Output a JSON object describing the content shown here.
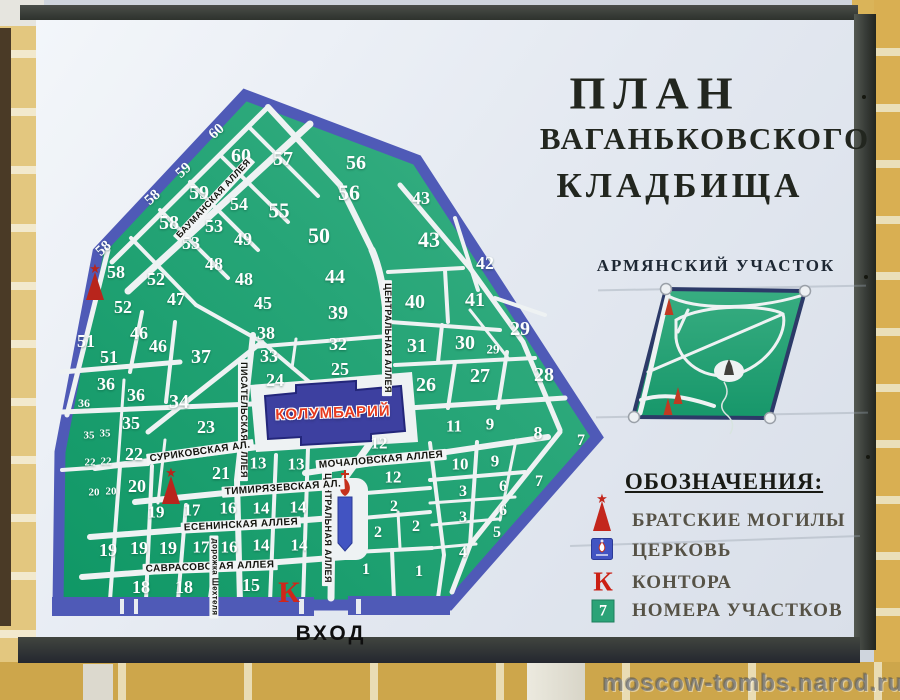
{
  "title": {
    "line1": "ПЛАН",
    "line2": "ВАГАНЬКОВСКОГО",
    "line3": "КЛАДБИЩА"
  },
  "armenian_section": {
    "label": "АРМЯНСКИЙ УЧАСТОК"
  },
  "legend": {
    "title": "ОБОЗНАЧЕНИЯ:",
    "items": [
      {
        "icon": "mass-graves-icon",
        "label": "БРАТСКИЕ МОГИЛЫ"
      },
      {
        "icon": "church-icon",
        "label": "ЦЕРКОВЬ"
      },
      {
        "icon": "office-icon",
        "label": "КОНТОРА",
        "symbol": "К"
      },
      {
        "icon": "plot-number-icon",
        "label": "НОМЕРА УЧАСТКОВ",
        "symbol": "7"
      }
    ]
  },
  "map": {
    "entrance_label": "ВХОД",
    "columbarium_label": "КОЛУМБАРИЙ",
    "office_symbol": "К",
    "plots": [
      {
        "t": "60",
        "x": 217,
        "y": 132,
        "s": 15,
        "r": -42
      },
      {
        "t": "60",
        "x": 241,
        "y": 156,
        "s": 20
      },
      {
        "t": "57",
        "x": 283,
        "y": 159,
        "s": 20
      },
      {
        "t": "56",
        "x": 356,
        "y": 163,
        "s": 20
      },
      {
        "t": "59",
        "x": 184,
        "y": 171,
        "s": 15,
        "r": -42
      },
      {
        "t": "59",
        "x": 199,
        "y": 193,
        "s": 20
      },
      {
        "t": "58",
        "x": 153,
        "y": 198,
        "s": 15,
        "r": -42
      },
      {
        "t": "58",
        "x": 169,
        "y": 223,
        "s": 20
      },
      {
        "t": "56",
        "x": 349,
        "y": 193,
        "s": 22
      },
      {
        "t": "54",
        "x": 239,
        "y": 204,
        "s": 18
      },
      {
        "t": "53",
        "x": 214,
        "y": 226,
        "s": 18
      },
      {
        "t": "55",
        "x": 279,
        "y": 211,
        "s": 21
      },
      {
        "t": "43",
        "x": 421,
        "y": 198,
        "s": 18
      },
      {
        "t": "49",
        "x": 243,
        "y": 239,
        "s": 18
      },
      {
        "t": "53",
        "x": 191,
        "y": 243,
        "s": 18
      },
      {
        "t": "50",
        "x": 319,
        "y": 236,
        "s": 22
      },
      {
        "t": "43",
        "x": 429,
        "y": 240,
        "s": 22
      },
      {
        "t": "58",
        "x": 104,
        "y": 249,
        "s": 15,
        "r": -42
      },
      {
        "t": "48",
        "x": 214,
        "y": 264,
        "s": 18
      },
      {
        "t": "58",
        "x": 116,
        "y": 272,
        "s": 18
      },
      {
        "t": "42",
        "x": 485,
        "y": 263,
        "s": 18
      },
      {
        "t": "48",
        "x": 244,
        "y": 279,
        "s": 18
      },
      {
        "t": "52",
        "x": 156,
        "y": 279,
        "s": 18
      },
      {
        "t": "44",
        "x": 335,
        "y": 277,
        "s": 20
      },
      {
        "t": "47",
        "x": 176,
        "y": 299,
        "s": 18
      },
      {
        "t": "45",
        "x": 263,
        "y": 303,
        "s": 18
      },
      {
        "t": "41",
        "x": 475,
        "y": 300,
        "s": 20
      },
      {
        "t": "40",
        "x": 415,
        "y": 302,
        "s": 20
      },
      {
        "t": "52",
        "x": 123,
        "y": 307,
        "s": 18
      },
      {
        "t": "39",
        "x": 338,
        "y": 313,
        "s": 20
      },
      {
        "t": "29",
        "x": 520,
        "y": 329,
        "s": 20
      },
      {
        "t": "46",
        "x": 139,
        "y": 333,
        "s": 18
      },
      {
        "t": "38",
        "x": 266,
        "y": 333,
        "s": 18
      },
      {
        "t": "51",
        "x": 86,
        "y": 341,
        "s": 18
      },
      {
        "t": "32",
        "x": 338,
        "y": 344,
        "s": 18
      },
      {
        "t": "31",
        "x": 417,
        "y": 346,
        "s": 20
      },
      {
        "t": "30",
        "x": 465,
        "y": 343,
        "s": 20
      },
      {
        "t": "46",
        "x": 158,
        "y": 346,
        "s": 18
      },
      {
        "t": "29",
        "x": 493,
        "y": 349,
        "s": 13
      },
      {
        "t": "51",
        "x": 109,
        "y": 357,
        "s": 18
      },
      {
        "t": "37",
        "x": 201,
        "y": 357,
        "s": 20
      },
      {
        "t": "33",
        "x": 269,
        "y": 356,
        "s": 18
      },
      {
        "t": "25",
        "x": 340,
        "y": 369,
        "s": 18
      },
      {
        "t": "28",
        "x": 544,
        "y": 375,
        "s": 20
      },
      {
        "t": "27",
        "x": 480,
        "y": 376,
        "s": 20
      },
      {
        "t": "24",
        "x": 275,
        "y": 380,
        "s": 18
      },
      {
        "t": "36",
        "x": 106,
        "y": 384,
        "s": 18
      },
      {
        "t": "26",
        "x": 426,
        "y": 385,
        "s": 20
      },
      {
        "t": "36",
        "x": 136,
        "y": 395,
        "s": 18
      },
      {
        "t": "34",
        "x": 179,
        "y": 402,
        "s": 20
      },
      {
        "t": "36",
        "x": 84,
        "y": 403,
        "s": 12
      },
      {
        "t": "35",
        "x": 131,
        "y": 423,
        "s": 18
      },
      {
        "t": "23",
        "x": 206,
        "y": 427,
        "s": 18
      },
      {
        "t": "11",
        "x": 454,
        "y": 426,
        "s": 17
      },
      {
        "t": "9",
        "x": 490,
        "y": 424,
        "s": 17
      },
      {
        "t": "8",
        "x": 538,
        "y": 433,
        "s": 18
      },
      {
        "t": "35",
        "x": 89,
        "y": 436,
        "s": 11
      },
      {
        "t": "35",
        "x": 105,
        "y": 434,
        "s": 11
      },
      {
        "t": "7",
        "x": 581,
        "y": 441,
        "s": 16
      },
      {
        "t": "12",
        "x": 379,
        "y": 443,
        "s": 17
      },
      {
        "t": "22",
        "x": 134,
        "y": 454,
        "s": 18
      },
      {
        "t": "13",
        "x": 258,
        "y": 463,
        "s": 17
      },
      {
        "t": "22",
        "x": 90,
        "y": 463,
        "s": 11
      },
      {
        "t": "22",
        "x": 106,
        "y": 462,
        "s": 11
      },
      {
        "t": "13",
        "x": 296,
        "y": 464,
        "s": 17
      },
      {
        "t": "10",
        "x": 460,
        "y": 464,
        "s": 17
      },
      {
        "t": "9",
        "x": 495,
        "y": 461,
        "s": 17
      },
      {
        "t": "21",
        "x": 221,
        "y": 473,
        "s": 18
      },
      {
        "t": "12",
        "x": 393,
        "y": 477,
        "s": 17
      },
      {
        "t": "7",
        "x": 539,
        "y": 482,
        "s": 16
      },
      {
        "t": "20",
        "x": 137,
        "y": 486,
        "s": 18
      },
      {
        "t": "6",
        "x": 503,
        "y": 487,
        "s": 16
      },
      {
        "t": "3",
        "x": 463,
        "y": 492,
        "s": 16
      },
      {
        "t": "20",
        "x": 94,
        "y": 493,
        "s": 11
      },
      {
        "t": "20",
        "x": 111,
        "y": 492,
        "s": 11
      },
      {
        "t": "2",
        "x": 394,
        "y": 507,
        "s": 16
      },
      {
        "t": "14",
        "x": 261,
        "y": 508,
        "s": 17
      },
      {
        "t": "14",
        "x": 298,
        "y": 507,
        "s": 17
      },
      {
        "t": "16",
        "x": 228,
        "y": 508,
        "s": 17
      },
      {
        "t": "17",
        "x": 192,
        "y": 510,
        "s": 17
      },
      {
        "t": "19",
        "x": 156,
        "y": 512,
        "s": 17
      },
      {
        "t": "6",
        "x": 503,
        "y": 511,
        "s": 16
      },
      {
        "t": "3",
        "x": 463,
        "y": 518,
        "s": 16
      },
      {
        "t": "2",
        "x": 378,
        "y": 533,
        "s": 16
      },
      {
        "t": "2",
        "x": 416,
        "y": 527,
        "s": 16
      },
      {
        "t": "5",
        "x": 497,
        "y": 533,
        "s": 16
      },
      {
        "t": "19",
        "x": 108,
        "y": 550,
        "s": 18
      },
      {
        "t": "19",
        "x": 139,
        "y": 548,
        "s": 18
      },
      {
        "t": "19",
        "x": 168,
        "y": 548,
        "s": 18
      },
      {
        "t": "17",
        "x": 201,
        "y": 547,
        "s": 17
      },
      {
        "t": "16",
        "x": 229,
        "y": 547,
        "s": 17
      },
      {
        "t": "14",
        "x": 261,
        "y": 545,
        "s": 17
      },
      {
        "t": "14",
        "x": 299,
        "y": 545,
        "s": 17
      },
      {
        "t": "4",
        "x": 463,
        "y": 553,
        "s": 16
      },
      {
        "t": "1",
        "x": 366,
        "y": 570,
        "s": 16
      },
      {
        "t": "1",
        "x": 419,
        "y": 572,
        "s": 16
      },
      {
        "t": "18",
        "x": 141,
        "y": 587,
        "s": 18
      },
      {
        "t": "18",
        "x": 184,
        "y": 587,
        "s": 18
      },
      {
        "t": "15",
        "x": 251,
        "y": 585,
        "s": 18
      }
    ],
    "alleys": [
      {
        "t": "БАУМАНСКАЯ АЛЛЕЯ",
        "x": 214,
        "y": 199,
        "r": -47,
        "s": 9
      },
      {
        "t": "ЦЕНТРАЛЬНАЯ АЛЛЕЯ",
        "x": 387,
        "y": 338,
        "r": 90,
        "s": 9
      },
      {
        "t": "ЦЕНТРАЛЬНАЯ АЛЛЕЯ",
        "x": 327,
        "y": 528,
        "r": 90,
        "s": 9
      },
      {
        "t": "ПИСАТЕЛЬСКАЯ АЛЛЕЯ",
        "x": 243,
        "y": 420,
        "r": 90,
        "s": 9
      },
      {
        "t": "МОЧАЛОВСКАЯ  АЛЛЕЯ",
        "x": 381,
        "y": 460,
        "r": -5,
        "s": 10
      },
      {
        "t": "СУРИКОВСКАЯ АЛ.",
        "x": 200,
        "y": 452,
        "r": -8,
        "s": 10
      },
      {
        "t": "ТИМИРЯЗЕВСКАЯ АЛ.",
        "x": 283,
        "y": 488,
        "r": -4,
        "s": 10
      },
      {
        "t": "ЕСЕНИНСКАЯ АЛЛЕЯ",
        "x": 241,
        "y": 525,
        "r": -3,
        "s": 10
      },
      {
        "t": "САВРАСОВСКАЯ  АЛЛЕЯ",
        "x": 210,
        "y": 567,
        "r": -2,
        "s": 10
      },
      {
        "t": "дорожка Шехтеля",
        "x": 214,
        "y": 577,
        "r": 90,
        "s": 8
      }
    ]
  },
  "watermark": "moscow-tombs.narod.ru",
  "colors": {
    "map_green": "#22a173",
    "border_blue": "#4f5ab7",
    "wall_ochre": "#d9b35e",
    "frame_dark": "#3c403c",
    "legend_red": "#c3261c",
    "church_blue": "#4254c2",
    "columbarium_blue": "#3d40a0"
  }
}
